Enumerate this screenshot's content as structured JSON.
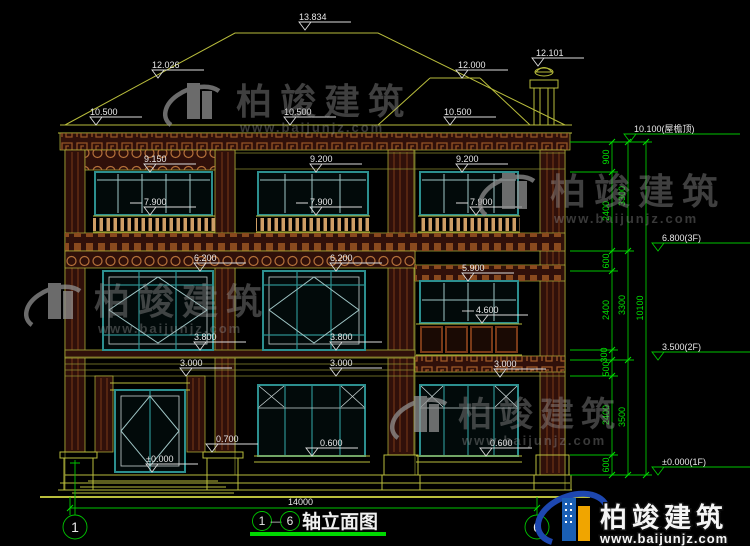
{
  "drawing": {
    "type": "architectural-elevation",
    "bottom_dimension": "14000",
    "axes": {
      "start": "1",
      "end": "6"
    },
    "title": {
      "axis_from": "1",
      "axis_to": "6",
      "separator": "—",
      "text": "轴立面图"
    }
  },
  "elevations": {
    "ridge": "13.834",
    "hip_left": "12.026",
    "ridge_right": "12.000",
    "chimney": "12.101",
    "eave_left": "10.500",
    "eave_center": "10.500",
    "eave_right": "10.500",
    "f3_left_window_top": "9.150",
    "f3_mid_window_top": "9.200",
    "f3_right_window_top": "9.200",
    "f3_rail_left": "7.900",
    "f3_rail_mid": "7.900",
    "f3_rail_right": "7.900",
    "f2_left_window_top": "6.200",
    "f2_mid_window_top": "6.200",
    "f2_right_window_top": "5.900",
    "f2_right_balcony": "4.600",
    "f2_left_sill": "3.800",
    "f2_mid_sill": "3.800",
    "band_left": "3.000",
    "band_mid": "3.000",
    "band_right": "3.000",
    "porch_base": "0.700",
    "f1_mid_sill": "0.600",
    "f1_right_sill": "0.600",
    "ground": "±0.000"
  },
  "right_dims": {
    "chain1": [
      "900",
      "2400",
      "600",
      "2400",
      "300",
      "500",
      "2400",
      "600"
    ],
    "chain2": [
      "3300",
      "3300",
      "3500"
    ],
    "total": "10100",
    "levels": [
      "10.100(屋檐顶)",
      "6.800(3F)",
      "3.500(2F)",
      "±0.000(1F)"
    ]
  },
  "watermark": {
    "brand": "柏竣建筑",
    "url": "www.baijunjz.com"
  },
  "colors": {
    "background": "#000000",
    "line_yellow": "#b9bd3c",
    "dim_green": "#00d800",
    "window_teal": "#2c8f8f",
    "band_maroon": "#30100a",
    "baluster_tan": "#cf9e66",
    "text_white": "#e8e8e8",
    "logo_blue": "#1a5fb4",
    "logo_orange": "#f0a500"
  }
}
